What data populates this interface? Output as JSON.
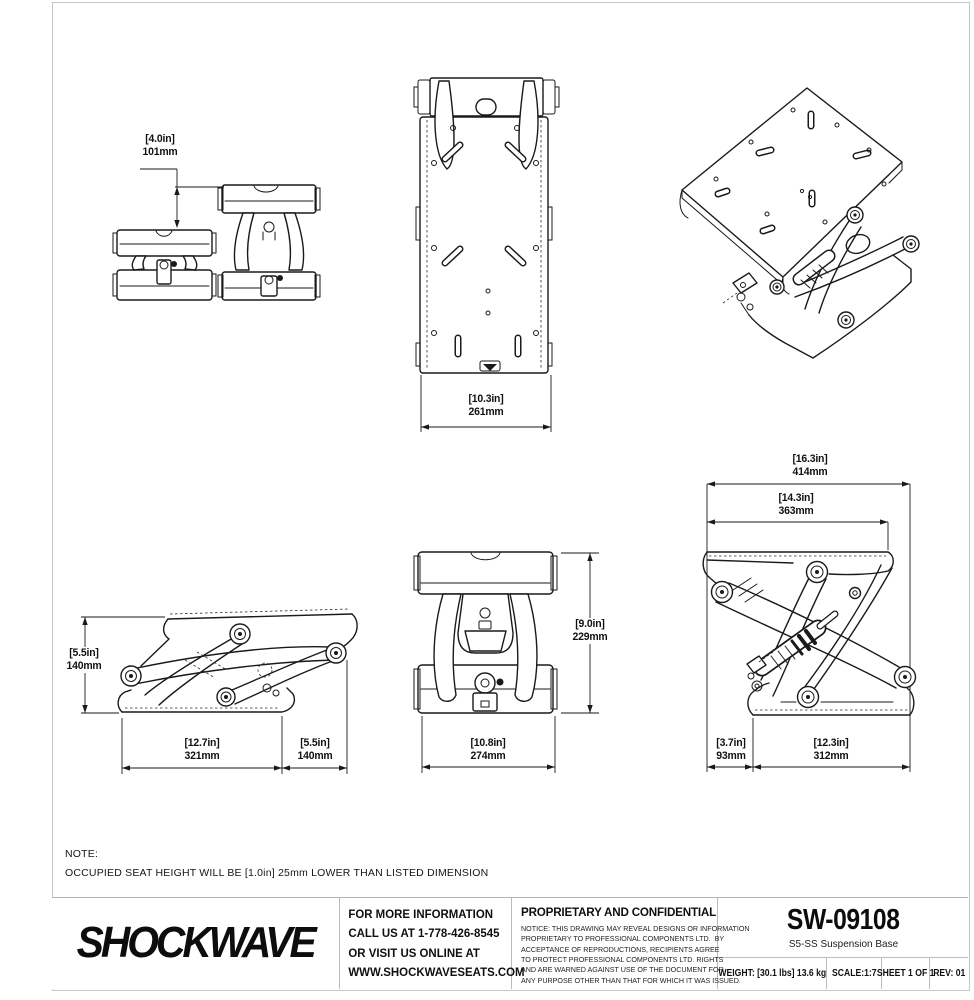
{
  "note": {
    "label": "NOTE:",
    "text": "OCCUPIED SEAT HEIGHT WILL BE [1.0in] 25mm LOWER THAN LISTED DIMENSION"
  },
  "dims": {
    "travel": {
      "in": "[4.0in]",
      "mm": "101mm"
    },
    "plate_width": {
      "in": "[10.3in]",
      "mm": "261mm"
    },
    "collapsed_height": {
      "in": "[5.5in]",
      "mm": "140mm"
    },
    "base_length_side": {
      "in": "[12.7in]",
      "mm": "321mm"
    },
    "rear_overhang": {
      "in": "[5.5in]",
      "mm": "140mm"
    },
    "extended_height": {
      "in": "[9.0in]",
      "mm": "229mm"
    },
    "front_width": {
      "in": "[10.8in]",
      "mm": "274mm"
    },
    "overall_length": {
      "in": "[16.3in]",
      "mm": "414mm"
    },
    "top_plate_length": {
      "in": "[14.3in]",
      "mm": "363mm"
    },
    "front_offset": {
      "in": "[3.7in]",
      "mm": "93mm"
    },
    "base_length_rear": {
      "in": "[12.3in]",
      "mm": "312mm"
    }
  },
  "title_block": {
    "logo": "SHOCKWAVE",
    "contact": "FOR MORE INFORMATION\nCALL US AT 1-778-426-8545\nOR VISIT US ONLINE AT\nWWW.SHOCKWAVESEATS.COM",
    "proprietary_heading": "PROPRIETARY AND CONFIDENTIAL",
    "proprietary_body": "NOTICE: THIS DRAWING MAY REVEAL DESIGNS OR INFORMATION\nPROPRIETARY TO PROFESSIONAL COMPONENTS LTD.  BY\nACCEPTANCE OF REPRODUCTIONS, RECIPIENTS AGREE\nTO PROTECT PROFESSIONAL COMPONENTS LTD. RIGHTS\nAND ARE WARNED AGAINST USE OF THE DOCUMENT FOR\nANY PURPOSE OTHER THAN THAT FOR WHICH IT WAS ISSUED.",
    "part_number": "SW-09108",
    "part_name": "S5-SS Suspension Base",
    "weight": "WEIGHT: [30.1 lbs] 13.6 kg",
    "scale": "SCALE:1:7",
    "sheet": "SHEET 1 OF 1",
    "rev": "REV: 01"
  },
  "colors": {
    "line": "#1a1a1a",
    "frame": "#c6c6c6"
  }
}
